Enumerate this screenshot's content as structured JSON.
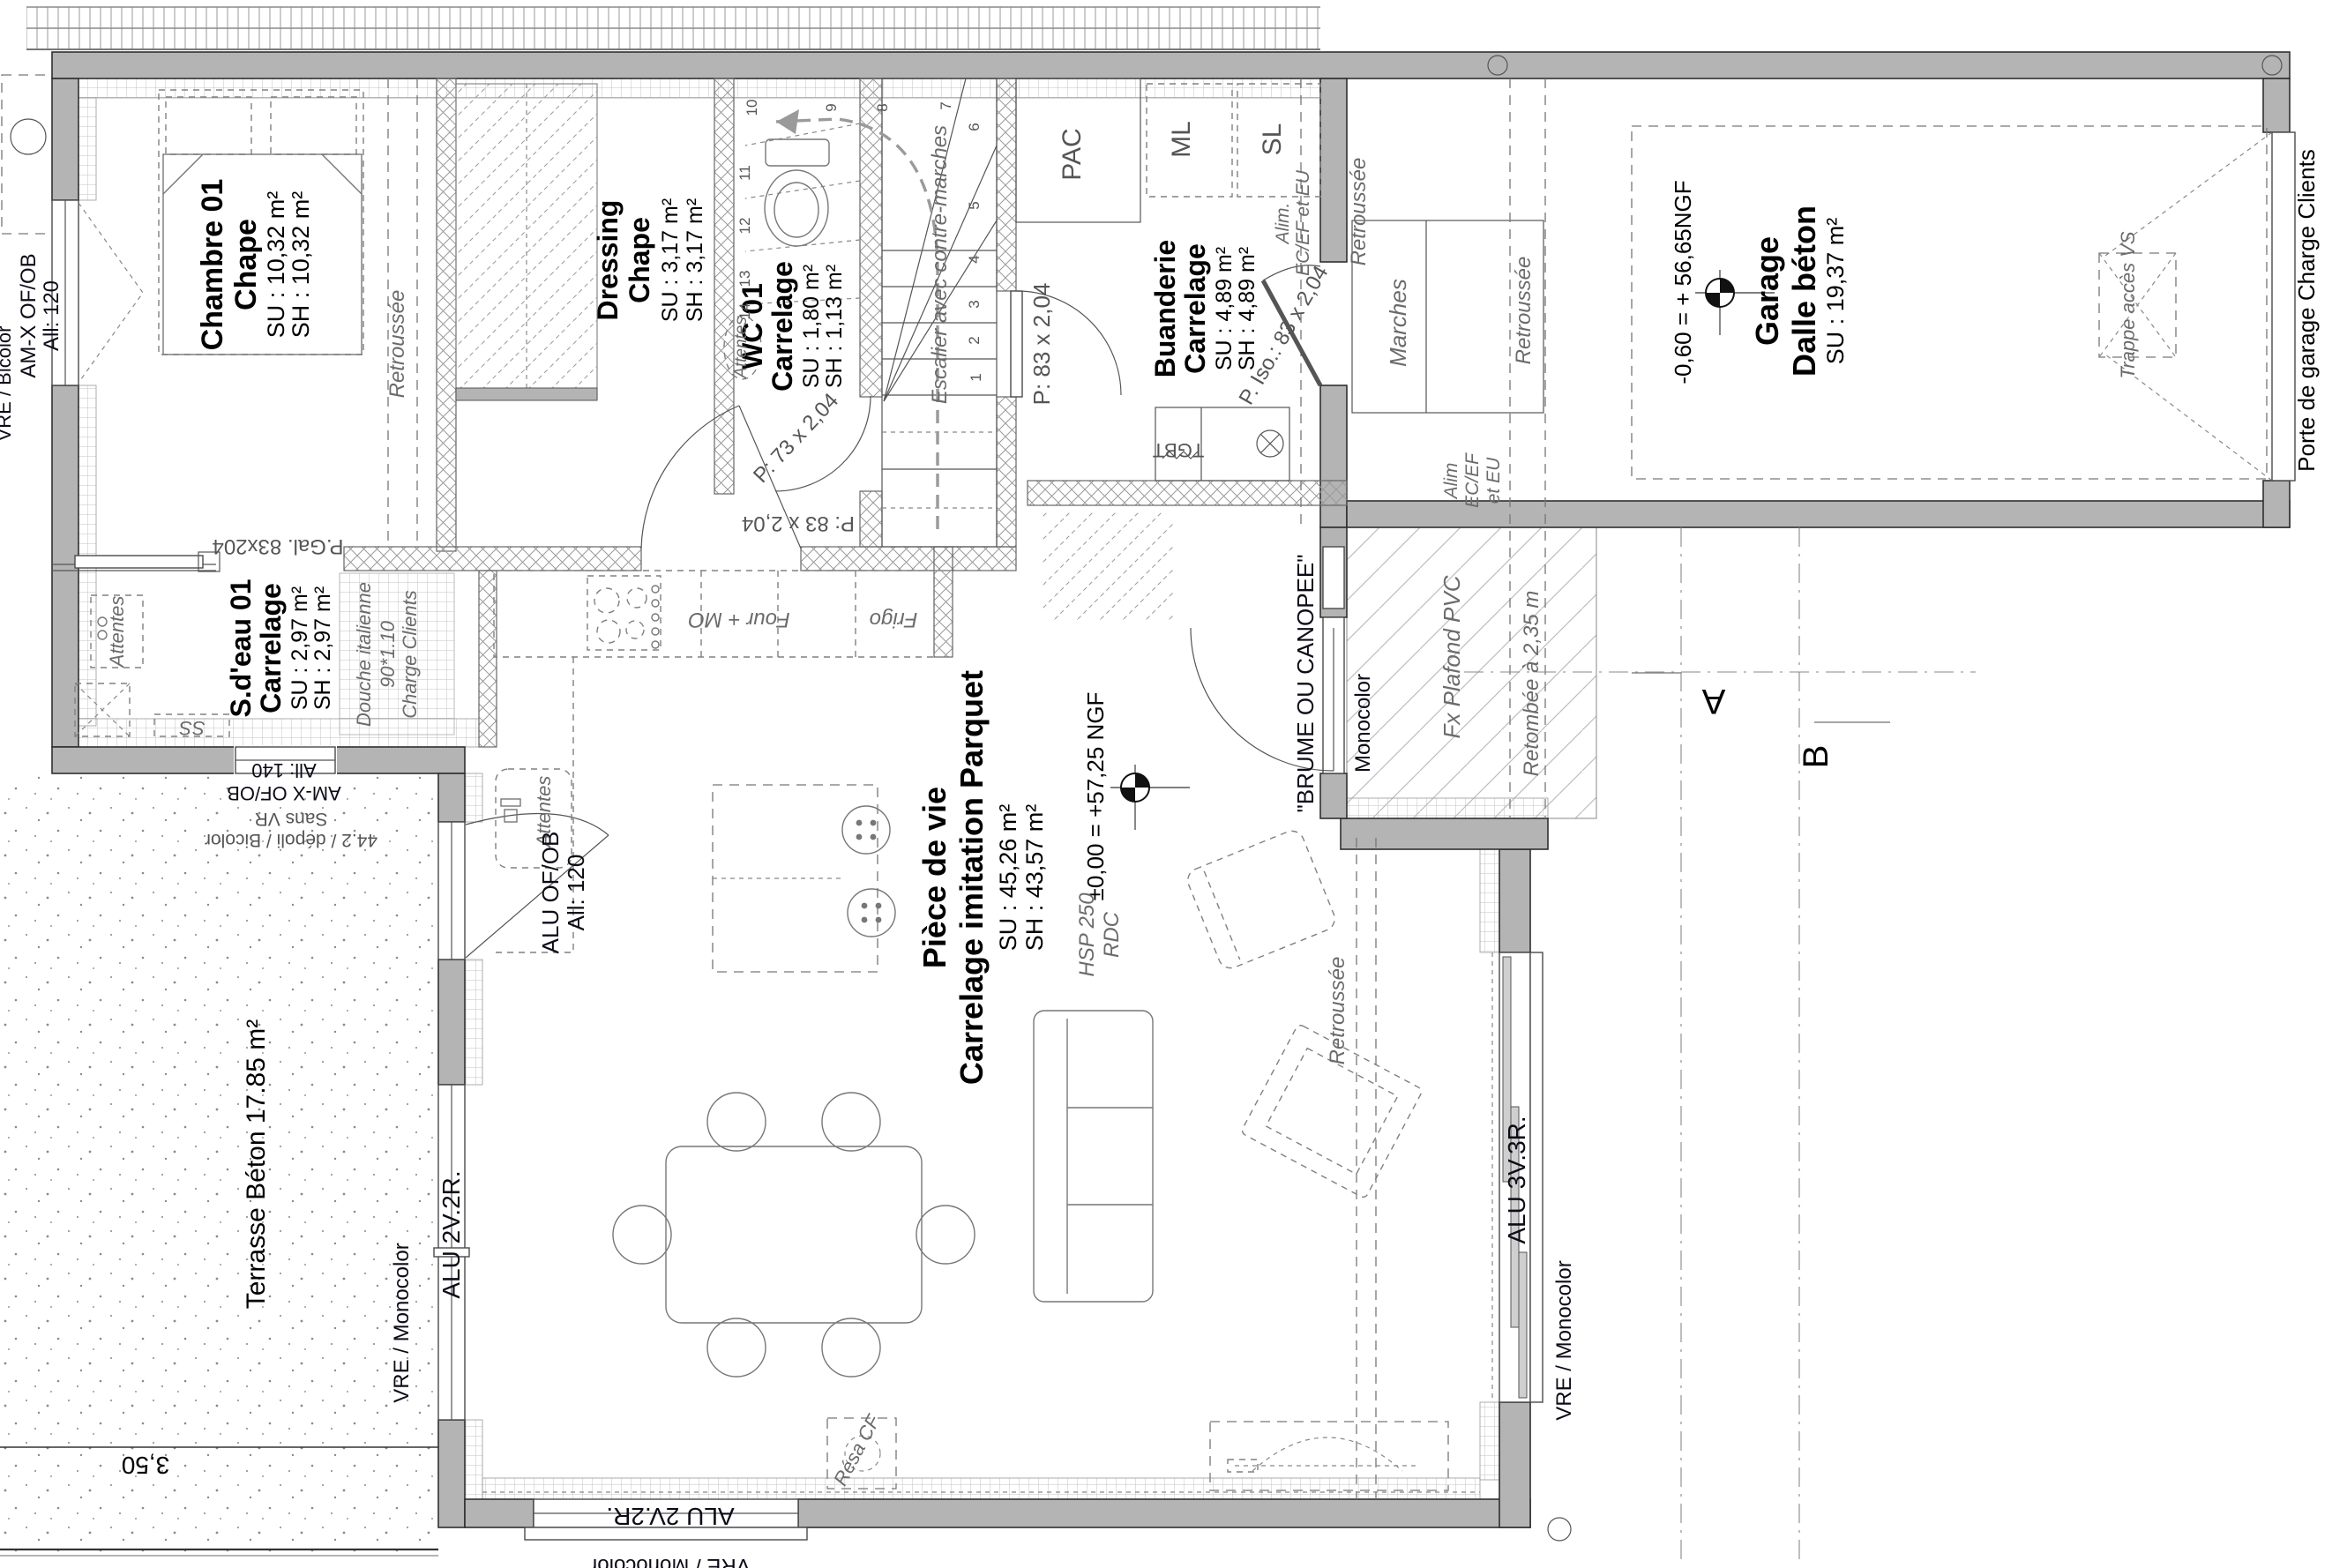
{
  "colors": {
    "wall_gray": "#b4b4b4",
    "line_dark": "#2f2f2f",
    "muted_gray": "#6b6b6b",
    "window_label": "#0c0c18"
  },
  "rooms": {
    "chambre": {
      "title": "Chambre 01",
      "finish": "Chape",
      "su": "SU : 10,32 m²",
      "sh": "SH : 10,32 m²"
    },
    "dressing": {
      "title": "Dressing",
      "finish": "Chape",
      "su": "SU : 3,17 m²",
      "sh": "SH : 3,17 m²"
    },
    "wc": {
      "title": "WC 01",
      "finish": "Carrelage",
      "su": "SU : 1,80 m²",
      "sh": "SH : 1,13 m²"
    },
    "buanderie": {
      "title": "Buanderie",
      "finish": "Carrelage",
      "su": "SU : 4,89 m²",
      "sh": "SH : 4,89 m²"
    },
    "sdeau": {
      "title": "S.d'eau 01",
      "finish": "Carrelage",
      "su": "SU : 2,97 m²",
      "sh": "SH : 2,97 m²"
    },
    "piece_de_vie": {
      "title": "Pièce de vie",
      "finish": "Carrelage imitation Parquet",
      "su": "SU : 45,26 m²",
      "sh": "SH : 43,57 m²"
    },
    "garage": {
      "title": "Garage",
      "finish": "Dalle béton",
      "su": "SU : 19,37 m²"
    },
    "terrasse": {
      "label": "Terrasse Béton 17.85 m²"
    }
  },
  "equipment": {
    "pac": "PAC",
    "ml": "ML",
    "sl": "SL",
    "tgbt": "TGBT",
    "four_mo": "Four + MO",
    "frigo": "Frigo",
    "ss": "SS",
    "resa_cf": "Résa CF",
    "attentes": "Attentes",
    "douche_l1": "Douche italienne",
    "douche_l2": "90*1.10",
    "douche_l3": "Charge Clients",
    "trappe_vs": "Trappe accès VS",
    "marches": "Marches",
    "escalier": "Escalier avec contre-marches"
  },
  "doors": {
    "p_gal": "P.Gal. 83x204",
    "p_83": "P: 83 x 2,04",
    "p_73": "P: 73 x 2,04",
    "p_iso": "P. Iso.: 83 x 2,04",
    "entree": "\"BRUME OU CANOPEE\"",
    "porte_garage": "Porte de garage Charge Clients"
  },
  "windows": {
    "amx120_l1": "AM-X OF/OB",
    "amx120_l2": "All: 120",
    "amx140_l1": "AM-X OF/OB",
    "amx140_l2": "All: 140",
    "alu_ofob_l1": "ALU OF/OB",
    "alu_ofob_l2": "All: 120",
    "alu_2v2r_left": "ALU 2V.2R.",
    "alu_2v2r_bottom": "ALU 2V.2R.",
    "alu_3v3r": "ALU 3V.3R.",
    "vre_monocolor_left": "VRE / Monocolor",
    "vre_monocolor_right": "VRE / Monocolor",
    "vre_monocolor_bottom": "VRE / Monocolor",
    "vre_bicolor": "VRE / Bicolor",
    "vitrage_l1": "44.2 / dépoli / Bicolor",
    "vitrage_l2": "Sans VR",
    "monocolor": "Monocolor"
  },
  "levels": {
    "garage": "-0,60 = + 56,65NGF",
    "rdc": "±0,00 = +57,25 NGF",
    "hsp_l1": "HSP 250",
    "hsp_l2": "RDC"
  },
  "annotations": {
    "retroussee": "Retroussée",
    "retombee": "Retombée à 2,35 m",
    "fx_plafond": "Fx Plafond PVC",
    "alim1_l1": "Alim.",
    "alim1_l2": "EC/EF et EU",
    "alim2_l1": "Alim",
    "alim2_l2": "EC/EF",
    "alim2_l3": "et EU",
    "dim_terrasse": "3,50",
    "section_a": "A",
    "section_b": "B"
  },
  "stairs": {
    "n1": "1",
    "n2": "2",
    "n3": "3",
    "n4": "4",
    "n5": "5",
    "n6": "6",
    "n7": "7",
    "n8": "8",
    "n9": "9",
    "n10": "10",
    "n11": "11",
    "n12": "12",
    "n13": "13",
    "n14": "14"
  }
}
